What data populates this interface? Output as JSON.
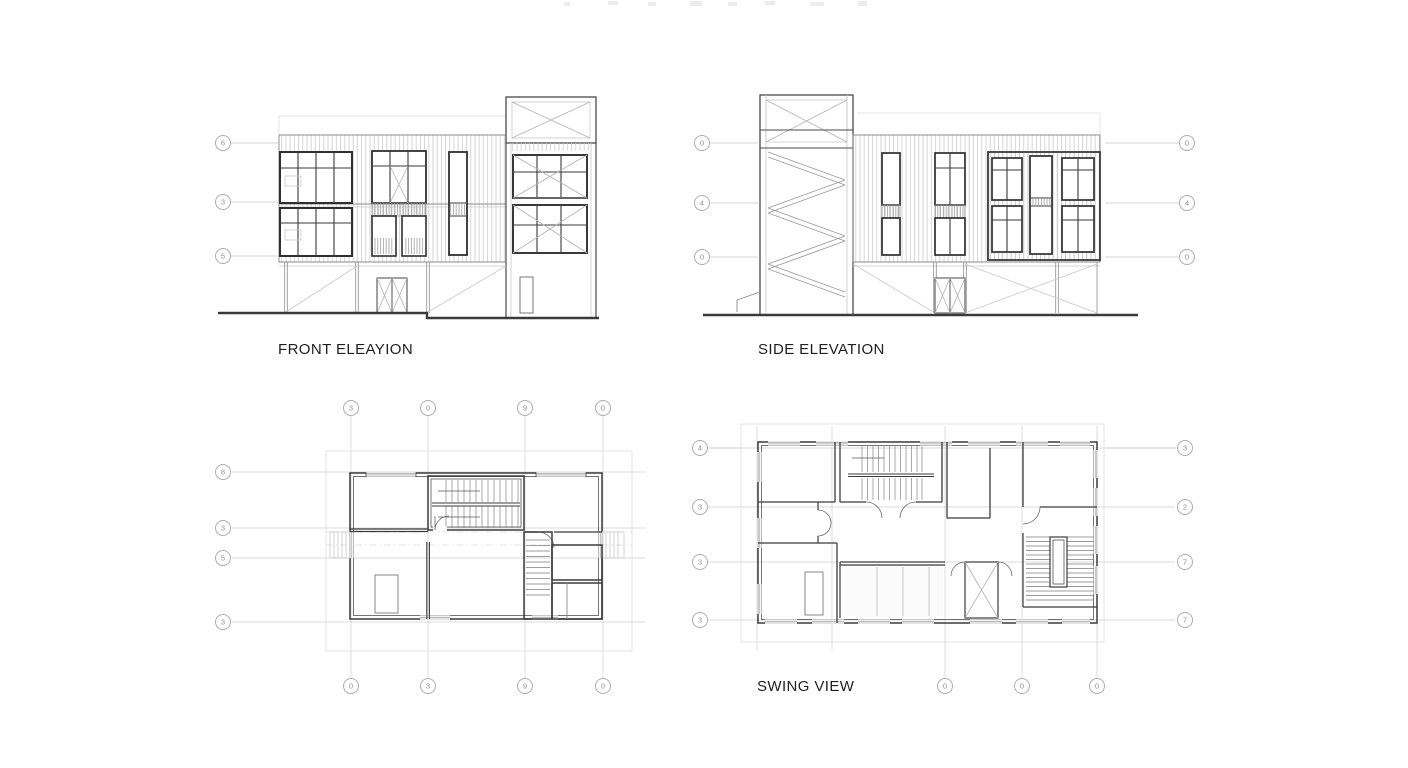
{
  "sheet": {
    "background": "#ffffff",
    "ink": "#3b3b3b",
    "muted": "#8a8a8a",
    "faint": "#dedede"
  },
  "panels": {
    "front_elevation": {
      "title": "FRONT ELEAYION",
      "grid_bubbles": {
        "left": [
          "6",
          "3",
          "5"
        ]
      }
    },
    "side_elevation": {
      "title": "SIDE ELEVATION",
      "grid_bubbles": {
        "left": [
          "0",
          "4",
          "0"
        ],
        "right": [
          "0",
          "4",
          "0"
        ]
      }
    },
    "floor_plan": {
      "grid_bubbles": {
        "top": [
          "3",
          "0",
          "9",
          "0"
        ],
        "left": [
          "8",
          "3",
          "5",
          "3"
        ],
        "bottom": [
          "0",
          "3",
          "9",
          "0"
        ]
      }
    },
    "swing_view": {
      "title": "SWING VIEW",
      "grid_bubbles": {
        "left": [
          "4",
          "3",
          "3",
          "3"
        ],
        "right": [
          "3",
          "2",
          "7",
          "7"
        ],
        "bottom": [
          "0",
          "0",
          "0"
        ]
      }
    }
  }
}
